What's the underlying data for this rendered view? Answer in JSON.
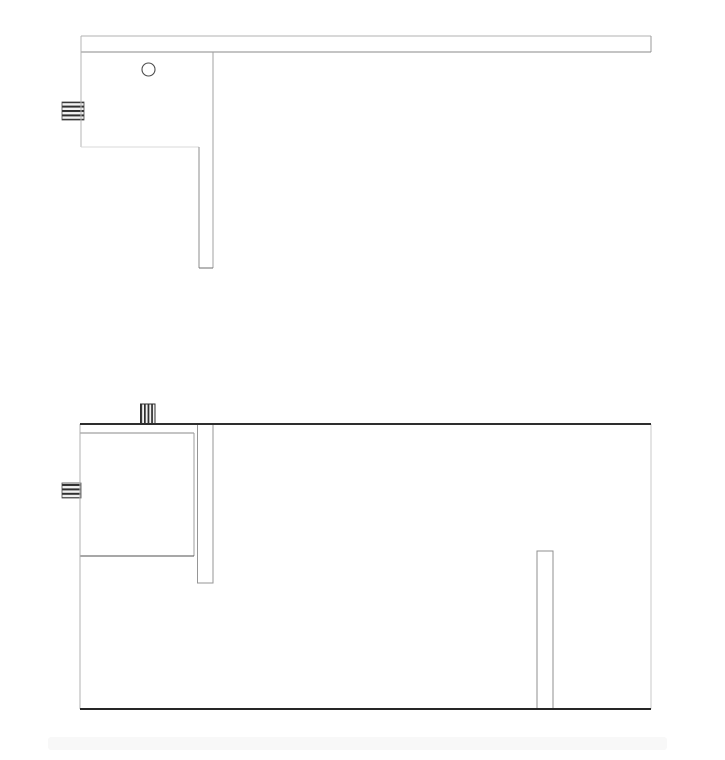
{
  "app": {
    "type": "technical-drawing-viewport",
    "background": "#ffffff"
  },
  "drawing": {
    "canvas": {
      "width": 725,
      "height": 760
    },
    "colors": {
      "background": "#ffffff",
      "line_dark": "#2e2e2e",
      "line_medium": "#8c8c8c",
      "line_light": "#b8b8b8",
      "line_faint": "#d9d9d9",
      "stripe_dark": "#2f2f2f",
      "stripe_light": "#f2f2f2",
      "footer_band": "#f8f8f8"
    },
    "views": [
      {
        "id": "top-view",
        "shapes": [
          {
            "type": "plug",
            "name": "left-port-plug",
            "x": 62,
            "y": 102,
            "w": 22,
            "h": 18,
            "dir": "h",
            "stroke": "#474747",
            "sw": 0.8
          },
          {
            "type": "line",
            "name": "rail-top-edge",
            "x1": 81,
            "y1": 36,
            "x2": 651,
            "y2": 36,
            "stroke": "#b2b2b2",
            "sw": 1
          },
          {
            "type": "line",
            "name": "rail-right-edge",
            "x1": 651,
            "y1": 36,
            "x2": 651,
            "y2": 52,
            "stroke": "#9a9a9a",
            "sw": 1
          },
          {
            "type": "line",
            "name": "rail-bottom-edge",
            "x1": 81,
            "y1": 52,
            "x2": 651,
            "y2": 52,
            "stroke": "#8a8a8a",
            "sw": 1
          },
          {
            "type": "line",
            "name": "body-left-edge",
            "x1": 81,
            "y1": 36,
            "x2": 81,
            "y2": 147,
            "stroke": "#b4b4b4",
            "sw": 1
          },
          {
            "type": "line",
            "name": "body-bottom-edge",
            "x1": 81,
            "y1": 147,
            "x2": 199,
            "y2": 147,
            "stroke": "#d9d9d9",
            "sw": 1
          },
          {
            "type": "line",
            "name": "body-right-edge",
            "x1": 213,
            "y1": 52,
            "x2": 213,
            "y2": 268,
            "stroke": "#a0a0a0",
            "sw": 1
          },
          {
            "type": "line",
            "name": "stem-left-edge",
            "x1": 199,
            "y1": 147,
            "x2": 199,
            "y2": 268,
            "stroke": "#8e8e8e",
            "sw": 1
          },
          {
            "type": "line",
            "name": "stem-bottom-edge",
            "x1": 199,
            "y1": 268,
            "x2": 213,
            "y2": 268,
            "stroke": "#6e6e6e",
            "sw": 1.2
          },
          {
            "type": "circle",
            "name": "hole",
            "cx": 148.5,
            "cy": 69.5,
            "r": 6.5,
            "stroke": "#4c4c4c",
            "sw": 1.1
          }
        ]
      },
      {
        "id": "front-view",
        "shapes": [
          {
            "type": "plug",
            "name": "top-port-plug",
            "x": 140.5,
            "y": 404,
            "w": 14.5,
            "h": 20,
            "dir": "v",
            "stroke": "#2f2f2f",
            "sw": 1
          },
          {
            "type": "plug",
            "name": "left-port-plug",
            "x": 62,
            "y": 483,
            "w": 19,
            "h": 15,
            "dir": "h",
            "stroke": "#474747",
            "sw": 0.8
          },
          {
            "type": "rect",
            "name": "inner-stem",
            "x": 197.5,
            "y": 424,
            "w": 15.5,
            "h": 159,
            "stroke": "#969696",
            "sw": 1,
            "fill": "#ffffff"
          },
          {
            "type": "line",
            "name": "compartment-top-edge",
            "x1": 80,
            "y1": 433,
            "x2": 194,
            "y2": 433,
            "stroke": "#8a8a8a",
            "sw": 1
          },
          {
            "type": "line",
            "name": "compartment-right-edge",
            "x1": 194,
            "y1": 433,
            "x2": 194,
            "y2": 556,
            "stroke": "#9c9c9c",
            "sw": 1
          },
          {
            "type": "line",
            "name": "compartment-bottom-edge",
            "x1": 80,
            "y1": 556,
            "x2": 194,
            "y2": 556,
            "stroke": "#4f4f4f",
            "sw": 1.3
          },
          {
            "type": "rect",
            "name": "right-stem",
            "x": 537,
            "y": 551,
            "w": 16,
            "h": 158,
            "stroke": "#8f8f8f",
            "sw": 1,
            "fill": "#ffffff"
          },
          {
            "type": "line",
            "name": "enclosure-left-edge",
            "x1": 80,
            "y1": 424,
            "x2": 80,
            "y2": 709,
            "stroke": "#b0b0b0",
            "sw": 1.2
          },
          {
            "type": "line",
            "name": "enclosure-right-edge",
            "x1": 651,
            "y1": 424,
            "x2": 651,
            "y2": 709,
            "stroke": "#c8c8c8",
            "sw": 1.4
          },
          {
            "type": "line",
            "name": "enclosure-top-edge",
            "x1": 80,
            "y1": 424,
            "x2": 651,
            "y2": 424,
            "stroke": "#2e2e2e",
            "sw": 2
          },
          {
            "type": "line",
            "name": "enclosure-bottom-edge",
            "x1": 80,
            "y1": 709,
            "x2": 651,
            "y2": 709,
            "stroke": "#262626",
            "sw": 2
          }
        ]
      },
      {
        "id": "footer",
        "shapes": [
          {
            "type": "rect",
            "name": "footer-shadow-band",
            "x": 48,
            "y": 737,
            "w": 619,
            "h": 13,
            "fill": "#f8f8f8",
            "stroke": "none",
            "sw": 0,
            "rx": 3
          }
        ]
      }
    ]
  }
}
